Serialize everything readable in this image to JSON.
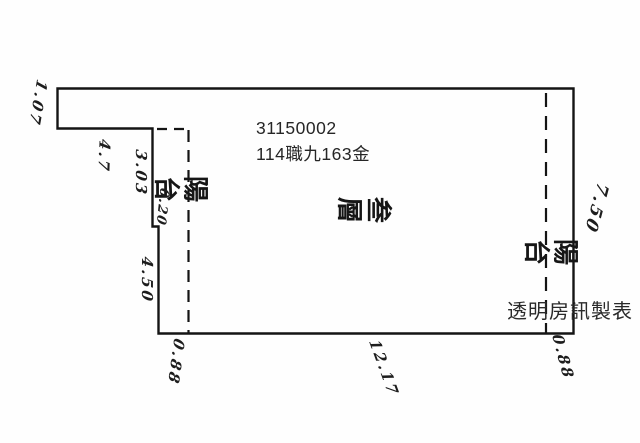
{
  "page": {
    "background": "#fefefe",
    "ink": "#141414"
  },
  "header": {
    "parcel_id": "31150002",
    "land_ref": "114職九163金"
  },
  "watermark": {
    "text": "透明房訊製表"
  },
  "room_labels": {
    "balcony_left": "陽台",
    "floor_center": "叁層",
    "balcony_right": "陽台"
  },
  "dimensions": [
    {
      "id": "top-left-edge",
      "value": "1.07"
    },
    {
      "id": "left-notch-offset",
      "value": "4.7"
    },
    {
      "id": "left-wall-upper",
      "value": "3.03"
    },
    {
      "id": "left-wall-step",
      "value": "0.20"
    },
    {
      "id": "left-wall-lower",
      "value": "4.50"
    },
    {
      "id": "bottom-balcony-left",
      "value": "0.88"
    },
    {
      "id": "bottom-width",
      "value": "12.17"
    },
    {
      "id": "bottom-balcony-right",
      "value": "0.88"
    },
    {
      "id": "right-wall",
      "value": "7.50"
    }
  ]
}
